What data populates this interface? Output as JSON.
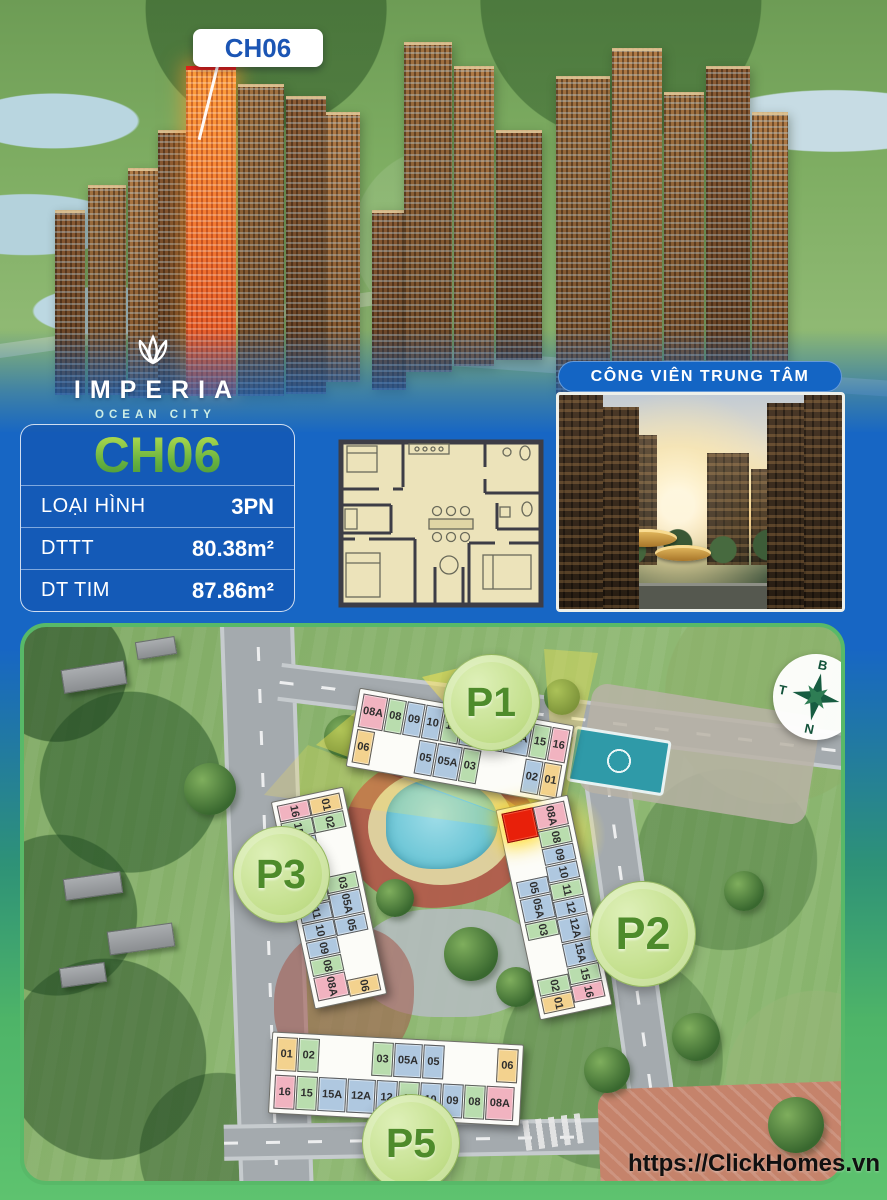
{
  "hero": {
    "unit_label": "CH06"
  },
  "logo": {
    "name": "IMPERIA",
    "subtitle": "OCEAN CITY"
  },
  "unit_card": {
    "title": "CH06",
    "rows": [
      {
        "label": "LOẠI HÌNH",
        "value": "3PN"
      },
      {
        "label": "DTTT",
        "value": "80.38m²"
      },
      {
        "label": "DT TIM",
        "value": "87.86m²"
      }
    ]
  },
  "park": {
    "banner": "CÔNG VIÊN TRUNG TÂM"
  },
  "site_plan": {
    "url": "https://ClickHomes.vn",
    "compass": {
      "north": "B",
      "east": "Đ",
      "south": "N",
      "west": "T"
    },
    "palette": {
      "pink": "#f1b3c0",
      "green": "#b9ddae",
      "blue": "#afc8e0",
      "yellow": "#f3d28e",
      "red": "#e8200a"
    },
    "buildings": [
      {
        "id": "P1",
        "badge": "P1",
        "orientation": "horizontal",
        "rows": [
          [
            {
              "l": "08A",
              "c": "pink"
            },
            {
              "l": "08",
              "c": "green"
            },
            {
              "l": "09",
              "c": "blue"
            },
            {
              "l": "10",
              "c": "blue"
            },
            {
              "l": "11",
              "c": "green"
            },
            {
              "l": "12",
              "c": "blue"
            },
            {
              "l": "12A",
              "c": "blue"
            },
            {
              "l": "15A",
              "c": "blue"
            },
            {
              "l": "15",
              "c": "green"
            },
            {
              "l": "16",
              "c": "pink"
            }
          ],
          [
            {
              "l": "06",
              "c": "yellow"
            },
            {
              "l": "",
              "c": "gap"
            },
            {
              "l": "05",
              "c": "blue"
            },
            {
              "l": "05A",
              "c": "blue"
            },
            {
              "l": "03",
              "c": "green"
            },
            {
              "l": "",
              "c": "gap"
            },
            {
              "l": "02",
              "c": "blue"
            },
            {
              "l": "01",
              "c": "yellow"
            }
          ]
        ]
      },
      {
        "id": "P3",
        "badge": "P3",
        "orientation": "vertical",
        "rows": [
          [
            {
              "l": "16",
              "c": "pink"
            },
            {
              "l": "15",
              "c": "green"
            },
            {
              "l": "15A",
              "c": "blue"
            },
            {
              "l": "12A",
              "c": "blue"
            },
            {
              "l": "12",
              "c": "green"
            },
            {
              "l": "11",
              "c": "blue"
            },
            {
              "l": "10",
              "c": "blue"
            },
            {
              "l": "09",
              "c": "blue"
            },
            {
              "l": "08",
              "c": "green"
            },
            {
              "l": "08A",
              "c": "pink"
            }
          ],
          [
            {
              "l": "01",
              "c": "yellow"
            },
            {
              "l": "02",
              "c": "green"
            },
            {
              "l": "",
              "c": "gap"
            },
            {
              "l": "03",
              "c": "green"
            },
            {
              "l": "05A",
              "c": "blue"
            },
            {
              "l": "05",
              "c": "blue"
            },
            {
              "l": "",
              "c": "gap"
            },
            {
              "l": "06",
              "c": "yellow"
            }
          ]
        ]
      },
      {
        "id": "P2",
        "badge": "P2",
        "orientation": "vertical",
        "rows": [
          [
            {
              "l": "",
              "c": "red"
            },
            {
              "l": "",
              "c": "gap"
            },
            {
              "l": "05",
              "c": "blue"
            },
            {
              "l": "05A",
              "c": "blue"
            },
            {
              "l": "03",
              "c": "green"
            },
            {
              "l": "",
              "c": "gap"
            },
            {
              "l": "02",
              "c": "green"
            },
            {
              "l": "01",
              "c": "yellow"
            }
          ],
          [
            {
              "l": "08A",
              "c": "pink"
            },
            {
              "l": "08",
              "c": "green"
            },
            {
              "l": "09",
              "c": "blue"
            },
            {
              "l": "10",
              "c": "blue"
            },
            {
              "l": "11",
              "c": "green"
            },
            {
              "l": "12",
              "c": "blue"
            },
            {
              "l": "12A",
              "c": "blue"
            },
            {
              "l": "15A",
              "c": "blue"
            },
            {
              "l": "15",
              "c": "green"
            },
            {
              "l": "16",
              "c": "pink"
            }
          ]
        ]
      },
      {
        "id": "P5",
        "badge": "P5",
        "orientation": "horizontal",
        "rows": [
          [
            {
              "l": "01",
              "c": "yellow"
            },
            {
              "l": "02",
              "c": "green"
            },
            {
              "l": "",
              "c": "gap"
            },
            {
              "l": "03",
              "c": "green"
            },
            {
              "l": "05A",
              "c": "blue"
            },
            {
              "l": "05",
              "c": "blue"
            },
            {
              "l": "",
              "c": "gap"
            },
            {
              "l": "06",
              "c": "yellow"
            }
          ],
          [
            {
              "l": "16",
              "c": "pink"
            },
            {
              "l": "15",
              "c": "green"
            },
            {
              "l": "15A",
              "c": "blue"
            },
            {
              "l": "12A",
              "c": "blue"
            },
            {
              "l": "12",
              "c": "blue"
            },
            {
              "l": "11",
              "c": "green"
            },
            {
              "l": "10",
              "c": "blue"
            },
            {
              "l": "09",
              "c": "blue"
            },
            {
              "l": "08",
              "c": "green"
            },
            {
              "l": "08A",
              "c": "pink"
            }
          ]
        ]
      }
    ]
  }
}
